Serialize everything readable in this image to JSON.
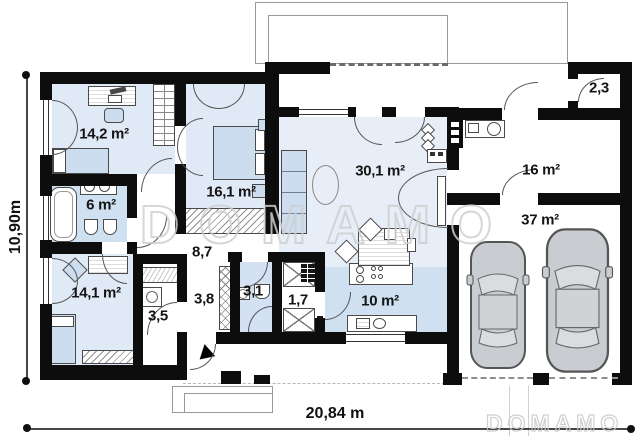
{
  "watermark": {
    "main": "DOMAMO",
    "footer": "DOMAMO"
  },
  "dimensions": {
    "height_label": "10,90m",
    "width_label": "20,84 m"
  },
  "rooms": {
    "bedroom_1": {
      "area": "14,2 m²"
    },
    "bedroom_2": {
      "area": "16,1 m²"
    },
    "bathroom_1": {
      "area": "6 m²"
    },
    "corridor": {
      "area": "8,7"
    },
    "living_room": {
      "area": "30,1 m²"
    },
    "vestibule": {
      "area": "2,3"
    },
    "storage": {
      "area": "16 m²"
    },
    "garage": {
      "area": "37 m²"
    },
    "bedroom_3": {
      "area": "14,1 m²"
    },
    "laundry": {
      "area": "3,5"
    },
    "hall": {
      "area": "3,8"
    },
    "bathroom_2": {
      "area": "3,1"
    },
    "pantry": {
      "area": "1,7"
    },
    "kitchen": {
      "area": "10 m²"
    }
  },
  "colors": {
    "wall": "#0d0d0d",
    "floor_light": "#e0eaf6",
    "floor_living": "#e7eef8",
    "floor_accent": "#cfe0f1",
    "furniture_blue": "#cdddf0",
    "watermark_outline": "#cfcfcf"
  }
}
